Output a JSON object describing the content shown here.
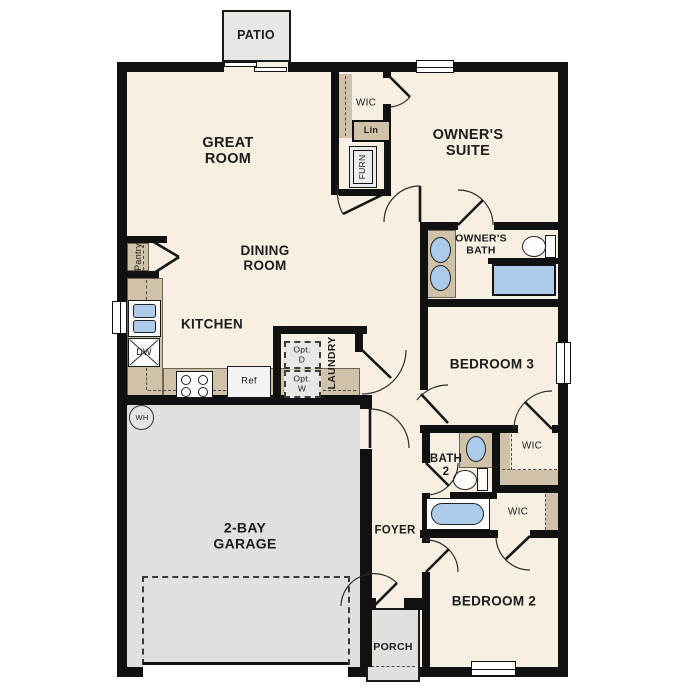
{
  "labels": {
    "patio": "PATIO",
    "great_room": "GREAT\nROOM",
    "wic": "WIC",
    "lin": "Lin",
    "furn": "FURN",
    "owners_suite": "OWNER'S\nSUITE",
    "dining_room": "DINING\nROOM",
    "pantry": "Pantry",
    "owners_bath": "OWNER'S\nBATH",
    "kitchen": "KITCHEN",
    "bedroom3": "BEDROOM 3",
    "opt_dryer": "Opt.\nD",
    "opt_washer": "Opt.\nW",
    "laundry": "LAUNDRY",
    "water_heater": "WH",
    "dishwasher": "DW",
    "refrigerator": "Ref",
    "bath2": "BATH\n2",
    "garage": "2-BAY\nGARAGE",
    "foyer": "FOYER",
    "bedroom2": "BEDROOM 2",
    "porch": "PORCH"
  },
  "colors": {
    "floor": "#f6efe2",
    "wall": "#111111",
    "hard_surface": "#e1e0dd",
    "counter": "#cfc2a9",
    "fixture_blue": "#abcbe9"
  }
}
